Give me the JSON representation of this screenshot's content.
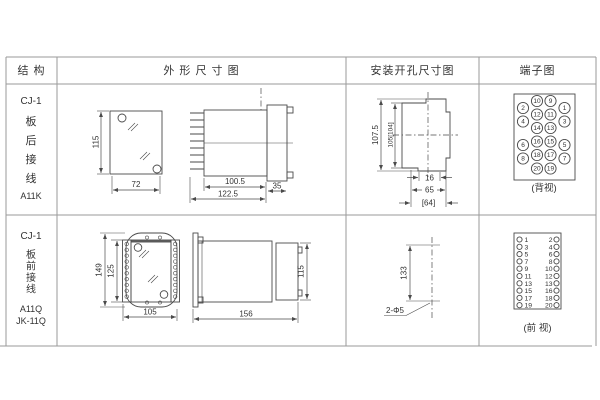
{
  "header": {
    "structure": "结 构",
    "outline": "外 形 尺 寸 图",
    "install": "安装开孔尺寸图",
    "terminal": "端子图"
  },
  "row1": {
    "model": "CJ-1",
    "w1": "板",
    "w2": "后",
    "w3": "接",
    "w4": "线",
    "code": "A11K",
    "dim_height": "115",
    "dim_width": "72",
    "dim_body": "100.5",
    "dim_total": "122.5",
    "dim_flange": "35",
    "dim_cut_outer": "107.5",
    "dim_cut_inner": "105[104]",
    "dim_notch": "16",
    "dim_cut_width": "65",
    "dim_cut_alt": "[64]",
    "terminal_view": "(背视)"
  },
  "row2": {
    "model": "CJ-1",
    "w1": "板",
    "w2": "前",
    "w3": "接",
    "w4": "线",
    "code": "A11Q",
    "code2": "JK-11Q",
    "dim_height": "149",
    "dim_inner_height": "125",
    "dim_width": "105",
    "dim_length": "156",
    "dim_side_height": "115",
    "dim_hole_span": "133",
    "hole_note": "2-Φ5",
    "terminal_view": "(前 视)"
  },
  "terminals": {
    "back_mid_rows": [
      [
        "10",
        "9"
      ],
      [
        "12",
        "11"
      ],
      [
        "14",
        "13"
      ],
      [
        "16",
        "15"
      ],
      [
        "18",
        "17"
      ],
      [
        "20",
        "19"
      ]
    ],
    "back_outer_rows": [
      [
        "2",
        "1"
      ],
      [
        "4",
        "3"
      ],
      [
        "6",
        "5"
      ],
      [
        "8",
        "7"
      ]
    ],
    "front_rows": [
      [
        "1",
        "2"
      ],
      [
        "3",
        "4"
      ],
      [
        "5",
        "6"
      ],
      [
        "7",
        "8"
      ],
      [
        "9",
        "10"
      ],
      [
        "11",
        "12"
      ],
      [
        "13",
        "13"
      ],
      [
        "15",
        "16"
      ],
      [
        "17",
        "18"
      ],
      [
        "19",
        "20"
      ]
    ]
  },
  "colors": {
    "line": "#4a4a4a",
    "table_line": "#9a9a9a",
    "text": "#333333",
    "background": "#ffffff"
  }
}
